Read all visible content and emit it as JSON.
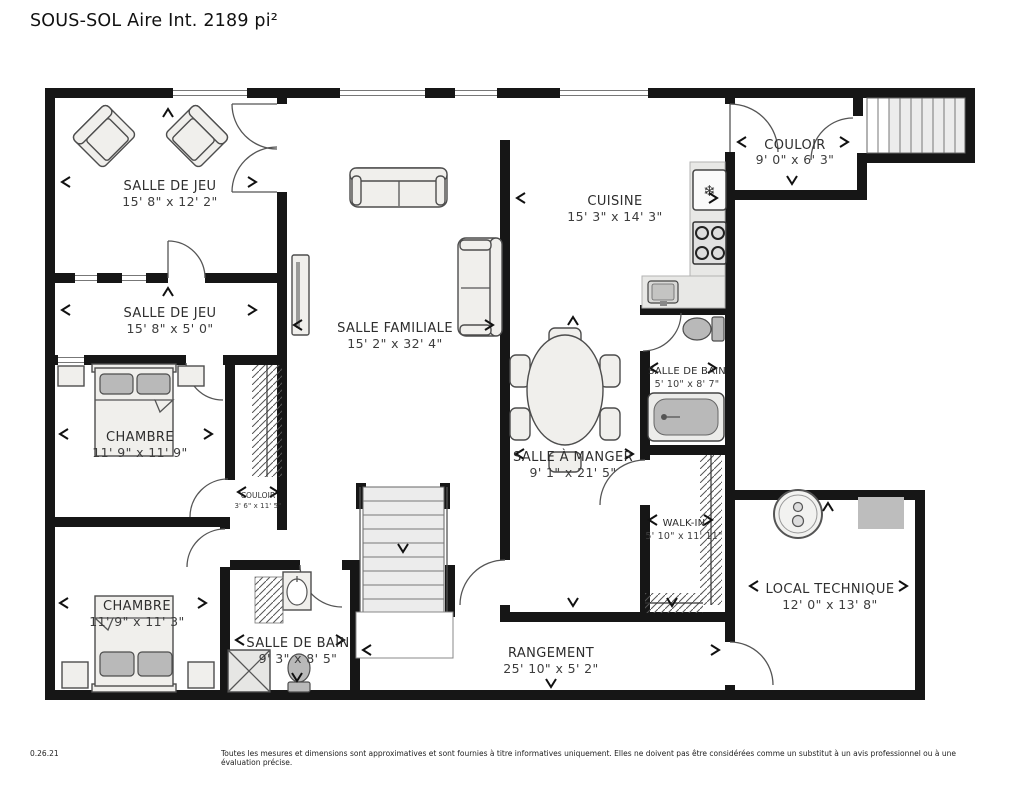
{
  "title": "SOUS-SOL Aire Int. 2189 pi²",
  "rooms": [
    {
      "id": "salle-de-jeu-1",
      "name": "SALLE DE JEU",
      "dims": "15' 8\" x 12' 2\""
    },
    {
      "id": "salle-de-jeu-2",
      "name": "SALLE DE JEU",
      "dims": "15' 8\" x 5' 0\""
    },
    {
      "id": "chambre-1",
      "name": "CHAMBRE",
      "dims": "11' 9\" x 11' 9\""
    },
    {
      "id": "couloir-2",
      "name": "COULOIR",
      "dims": "3' 6\" x 11' 5\""
    },
    {
      "id": "chambre-2",
      "name": "CHAMBRE",
      "dims": "11' 9\" x 11' 3\""
    },
    {
      "id": "salle-de-bain-2",
      "name": "SALLE DE BAIN",
      "dims": "9' 3\" x 8' 5\""
    },
    {
      "id": "salle-familiale",
      "name": "SALLE FAMILIALE",
      "dims": "15' 2\" x 32' 4\""
    },
    {
      "id": "salle-a-manger",
      "name": "SALLE À MANGER",
      "dims": "9' 1\" x 21' 5\""
    },
    {
      "id": "cuisine",
      "name": "CUISINE",
      "dims": "15' 3\" x 14' 3\""
    },
    {
      "id": "couloir-1",
      "name": "COULOIR",
      "dims": "9' 0\" x 6' 3\""
    },
    {
      "id": "salle-de-bain-1",
      "name": "SALLE DE BAIN",
      "dims": "5' 10\" x 8' 7\""
    },
    {
      "id": "walk-in",
      "name": "WALK-IN",
      "dims": "5' 10\" x 11' 11\""
    },
    {
      "id": "local-technique",
      "name": "LOCAL TECHNIQUE",
      "dims": "12' 0\" x 13' 8\""
    },
    {
      "id": "rangement",
      "name": "RANGEMENT",
      "dims": "25' 10\" x 5' 2\""
    }
  ],
  "footer": {
    "version": "0.26.21",
    "disclaimer": "Toutes les mesures et dimensions sont approximatives et sont fournies à titre informatives uniquement. Elles ne doivent pas être considérées comme un substitut à un avis professionnel ou à une évaluation précise."
  },
  "icons": {
    "fridge": "snowflake-icon",
    "stove": "stove-burners-icon",
    "water_heater": "water-heater-icon",
    "stairs_direction": "chevron-down-icon",
    "dimension_marker": "chevron-arrow-icon"
  },
  "colors": {
    "wall": "#161616",
    "furniture_fill": "#f0efec",
    "furniture_stroke": "#4d4d4d",
    "fixture_gray": "#b9b9b9",
    "counter": "#e8e8e6",
    "stair_fill": "#ececec",
    "text": "#2d2d2d",
    "background": "#ffffff"
  }
}
